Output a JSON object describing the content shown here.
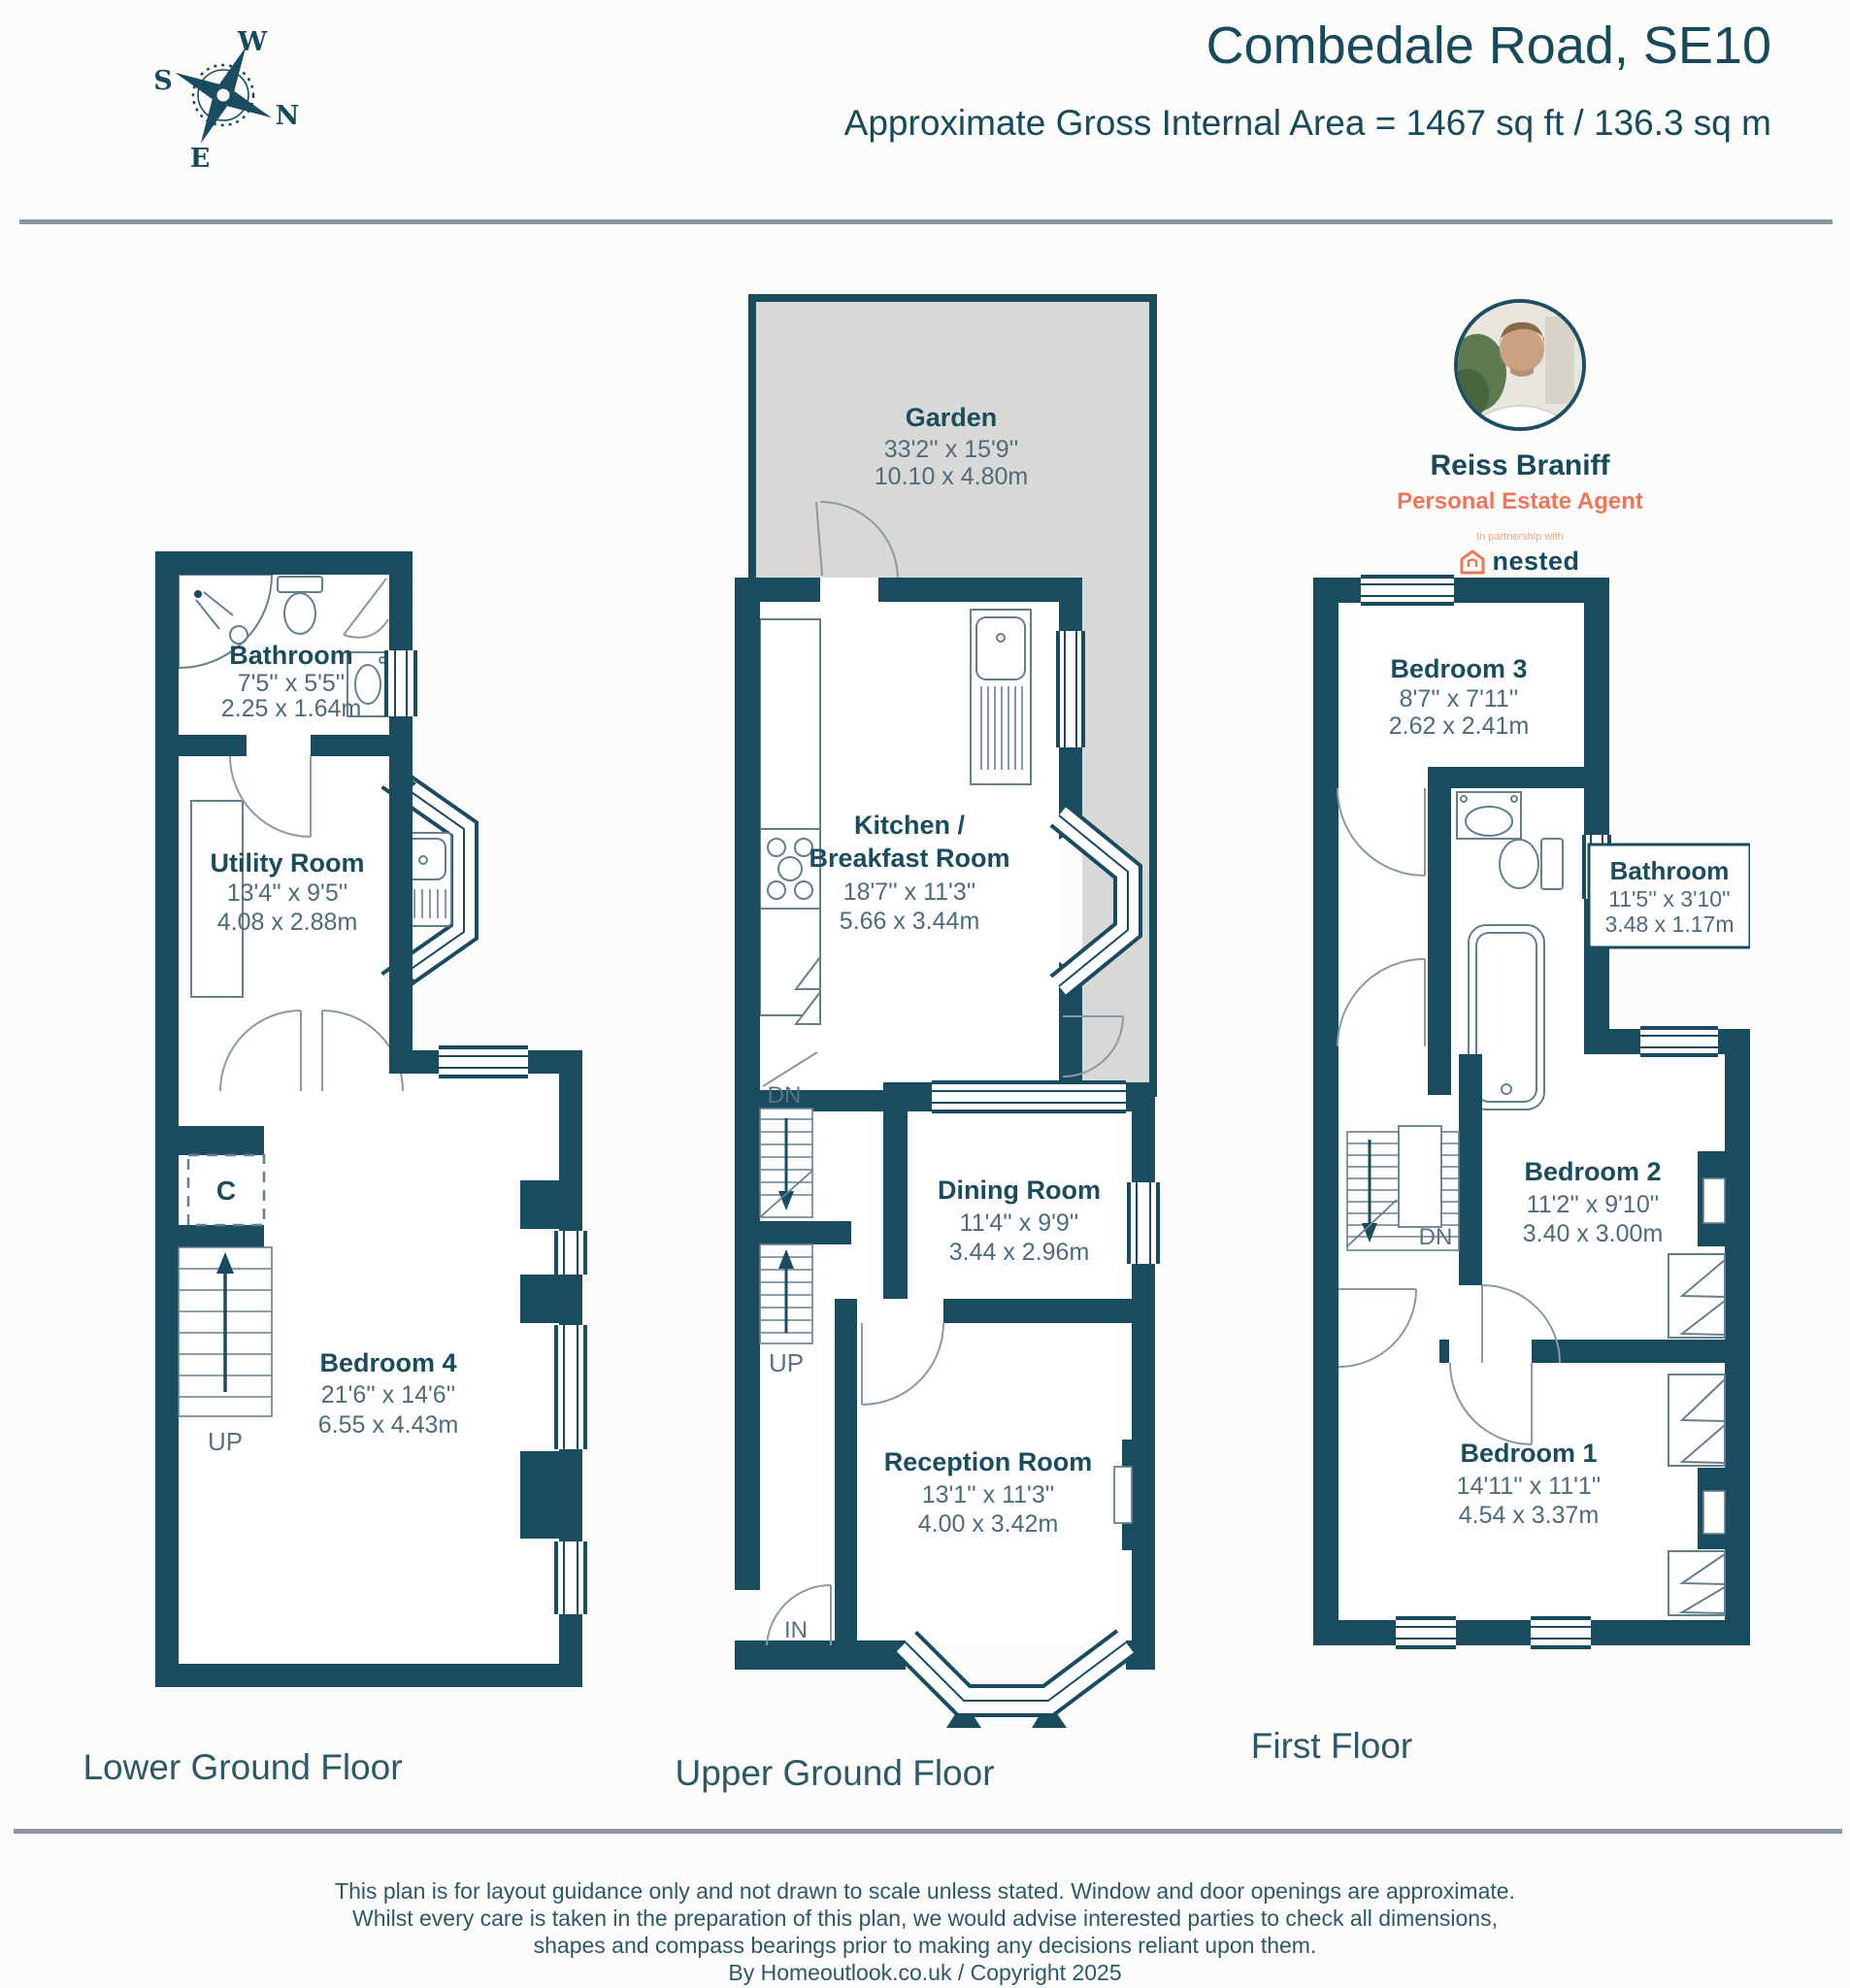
{
  "header": {
    "title": "Combedale Road, SE10",
    "subtitle": "Approximate Gross Internal Area = 1467 sq ft / 136.3 sq m"
  },
  "compass": {
    "w": "W",
    "n": "N",
    "e": "E",
    "s": "S"
  },
  "agent": {
    "name": "Reiss Braniff",
    "role": "Personal Estate Agent",
    "partnership": "In partnership with",
    "brand": "nested"
  },
  "floors": {
    "lower": {
      "label": "Lower Ground Floor",
      "stairs_up": "UP",
      "cupboard": "C",
      "rooms": {
        "bathroom": {
          "name": "Bathroom",
          "imperial": "7'5'' x 5'5''",
          "metric": "2.25 x 1.64m"
        },
        "utility": {
          "name": "Utility Room",
          "imperial": "13'4'' x 9'5''",
          "metric": "4.08 x 2.88m"
        },
        "bedroom4": {
          "name": "Bedroom 4",
          "imperial": "21'6'' x 14'6''",
          "metric": "6.55 x 4.43m"
        }
      }
    },
    "upper": {
      "label": "Upper Ground Floor",
      "stairs_dn": "DN",
      "stairs_up": "UP",
      "entrance": "IN",
      "rooms": {
        "garden": {
          "name": "Garden",
          "imperial": "33'2'' x 15'9''",
          "metric": "10.10 x 4.80m"
        },
        "kitchen": {
          "name_line1": "Kitchen /",
          "name_line2": "Breakfast Room",
          "imperial": "18'7'' x 11'3''",
          "metric": "5.66 x 3.44m"
        },
        "dining": {
          "name": "Dining Room",
          "imperial": "11'4'' x 9'9''",
          "metric": "3.44 x 2.96m"
        },
        "reception": {
          "name": "Reception Room",
          "imperial": "13'1'' x 11'3''",
          "metric": "4.00 x 3.42m"
        }
      }
    },
    "first": {
      "label": "First Floor",
      "stairs_dn": "DN",
      "rooms": {
        "bedroom3": {
          "name": "Bedroom 3",
          "imperial": "8'7'' x 7'11''",
          "metric": "2.62 x 2.41m"
        },
        "bathroom": {
          "name": "Bathroom",
          "imperial": "11'5'' x 3'10''",
          "metric": "3.48 x 1.17m"
        },
        "bedroom2": {
          "name": "Bedroom 2",
          "imperial": "11'2'' x 9'10''",
          "metric": "3.40 x 3.00m"
        },
        "bedroom1": {
          "name": "Bedroom 1",
          "imperial": "14'11'' x 11'1''",
          "metric": "4.54 x 3.37m"
        }
      }
    }
  },
  "footer": {
    "lines": {
      "l1": "This plan is for layout guidance only and not drawn to scale unless stated. Window and door openings are approximate.",
      "l2": "Whilst every care is taken in the preparation of this plan, we would advise interested parties to check all dimensions,",
      "l3": "shapes and compass bearings prior to making any decisions reliant upon them.",
      "l4": "By Homeoutlook.co.uk / Copyright 2025"
    }
  },
  "colors": {
    "wall": "#194c5e",
    "garden_fill": "#d8d8d6",
    "accent_coral": "#f0765b",
    "heading_text": "#174a5a",
    "divider_gray": "#8a979e"
  }
}
